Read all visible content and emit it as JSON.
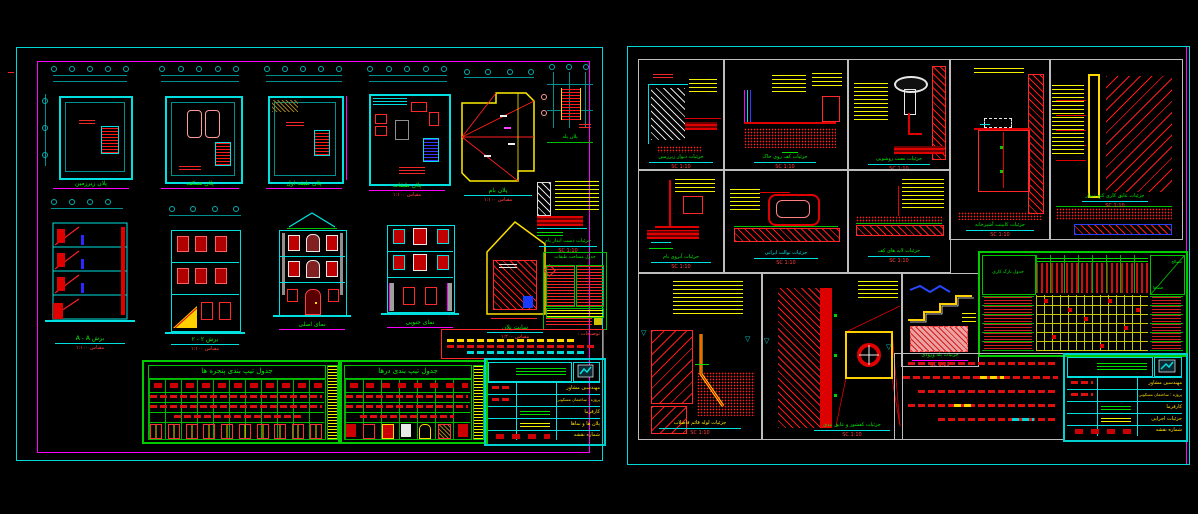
{
  "left_sheet": {
    "plans": [
      {
        "caption": "پلان زیرزمین",
        "scale": "مقیاس ۱:۱۰۰"
      },
      {
        "caption": "پلان همکف",
        "scale": "مقیاس ۱:۱۰۰"
      },
      {
        "caption": "پلان طبقه اول",
        "scale": "مقیاس ۱:۱۰۰"
      },
      {
        "caption": "پلان طبقات",
        "scale": "مقیاس ۱:۱۰۰"
      },
      {
        "caption": "پلان بام",
        "scale": "مقیاس ۱:۱۰۰"
      },
      {
        "caption": "پلان پله",
        "scale": "۱:۵۰"
      }
    ],
    "figures": {
      "section_a": {
        "caption": "برش A - A",
        "scale": "مقیاس ۱:۱۰۰"
      },
      "section_2": {
        "caption": "برش ۲ - ۲",
        "scale": "مقیاس ۱:۱۰۰"
      },
      "elevation_front": {
        "caption": "نمای اصلی"
      },
      "elevation_rear": {
        "caption": "نمای جنوبی"
      },
      "site_plan": {
        "caption": "سایت پلان",
        "scale": "مقیاس ۱:۲۰۰"
      },
      "parapet": {
        "caption": "جزئیات دست انداز بام",
        "scale": "SC 1:10"
      }
    },
    "area_table": {
      "title": "جدول مساحت طبقات"
    },
    "notes_title": "توضیحات :",
    "window_table": {
      "title": "جدول تیپ بندی پنجره ها"
    },
    "door_table": {
      "title": "جدول تیپ بندی درها"
    },
    "title_block": {
      "consultant": "مهندسین مشاور",
      "project": "پروژه : ساختمان مسکونی",
      "client": "کارفرما",
      "drawing": "پلان ها و نماها",
      "sheet_no": "شماره نقشه"
    }
  },
  "right_sheet": {
    "details": [
      {
        "caption": "جزئیات دیوار زیرزمین",
        "scale": "SC 1:10"
      },
      {
        "caption": "جزئیات کف روی خاک",
        "scale": "SC 1:10"
      },
      {
        "caption": "جزئیات نصب روشویی",
        "scale": "SC 1:10"
      },
      {
        "caption": "جزئیات کابینت آشپزخانه",
        "scale": "SC 1:10"
      },
      {
        "caption": "جزئیات عایق کاری کنج دیوار",
        "scale": "SC 1:10"
      },
      {
        "caption": "جزئیات آبروی بام",
        "scale": "SC 1:10"
      },
      {
        "caption": "جزئیات توالت ایرانی",
        "scale": "SC 1:10"
      },
      {
        "caption": "جزئیات لایه های کف",
        "scale": "SC 1:10"
      },
      {
        "caption": "جزئیات لوله قائم فاضلاب",
        "scale": "SC 1:10"
      },
      {
        "caption": "جزئیات کفشور و عایق بندی",
        "scale": "SC 1:10"
      },
      {
        "caption": "جزئیات پله ورودی",
        "scale": "SC 1:20"
      }
    ],
    "finish_table": {
      "title": "جدول نازک کاری",
      "corner_materials": "مصالح",
      "corner_spaces": "فضاها"
    },
    "title_block": {
      "consultant": "مهندسین مشاور",
      "project": "پروژه : ساختمان مسکونی",
      "client": "کارفرما",
      "drawing": "جزئیات اجرایی",
      "sheet_no": "شماره نقشه"
    }
  }
}
